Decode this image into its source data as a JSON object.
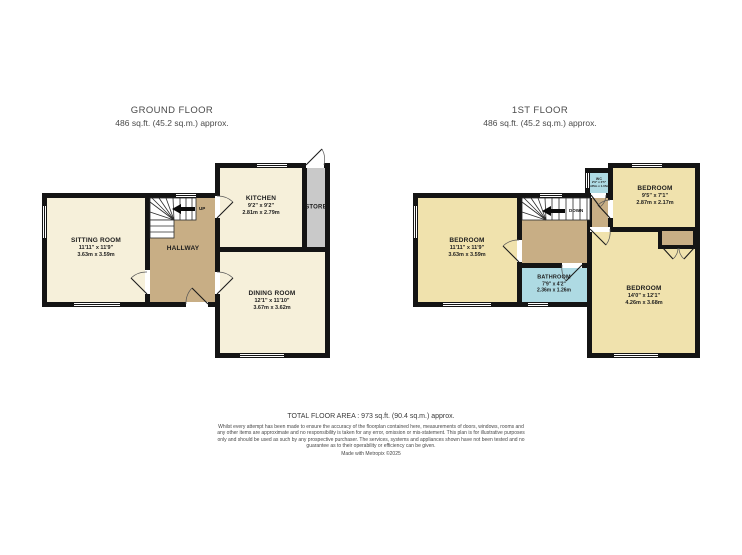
{
  "ground_floor": {
    "title": "GROUND FLOOR",
    "subtitle": "486 sq.ft. (45.2 sq.m.) approx.",
    "stairs_label": "UP",
    "rooms": {
      "sitting": {
        "name": "SITTING ROOM",
        "dims_ft": "11'11\" x 11'9\"",
        "dims_m": "3.63m x 3.59m"
      },
      "hallway": {
        "name": "HALLWAY"
      },
      "kitchen": {
        "name": "KITCHEN",
        "dims_ft": "9'2\" x 9'2\"",
        "dims_m": "2.81m x 2.79m"
      },
      "store": {
        "name": "STORE"
      },
      "dining": {
        "name": "DINING ROOM",
        "dims_ft": "12'1\" x 11'10\"",
        "dims_m": "3.67m x 3.62m"
      }
    }
  },
  "first_floor": {
    "title": "1ST FLOOR",
    "subtitle": "486 sq.ft. (45.2 sq.m.) approx.",
    "stairs_label": "DOWN",
    "rooms": {
      "bedroom_left": {
        "name": "BEDROOM",
        "dims_ft": "11'11\" x 11'9\"",
        "dims_m": "3.63m x 3.59m"
      },
      "bedroom_top": {
        "name": "BEDROOM",
        "dims_ft": "9'5\" x 7'1\"",
        "dims_m": "2.87m x 2.17m"
      },
      "bedroom_bottom": {
        "name": "BEDROOM",
        "dims_ft": "14'0\" x 12'1\"",
        "dims_m": "4.26m x 3.68m"
      },
      "bathroom": {
        "name": "BATHROOM",
        "dims_ft": "7'9\" x 4'2\"",
        "dims_m": "2.36m x 1.26m"
      },
      "wc": {
        "name": "WC",
        "dims_ft": "2'9\" x 3'5\"",
        "dims_m": "0.85m x 1.05m"
      }
    }
  },
  "footer": {
    "total": "TOTAL FLOOR AREA : 973 sq.ft. (90.4 sq.m.) approx.",
    "disclaimer": "Whilst every attempt has been made to ensure the accuracy of the floorplan contained here, measurements of doors, windows, rooms and any other items are approximate and no responsibility is taken for any error, omission or mis-statement. This plan is for illustrative purposes only and should be used as such by any prospective purchaser. The services, systems and appliances shown have not been tested and no guarantee as to their operability or efficiency can be given.",
    "credit": "Made with Metropix ©2025"
  },
  "colors": {
    "ground_room_fill": "#f6f0da",
    "first_room_fill": "#f0e2ad",
    "hall_landing_fill": "#c8ae85",
    "wet_room_fill": "#aedae3",
    "store_fill": "#c9c9c9",
    "wall": "#141414"
  }
}
